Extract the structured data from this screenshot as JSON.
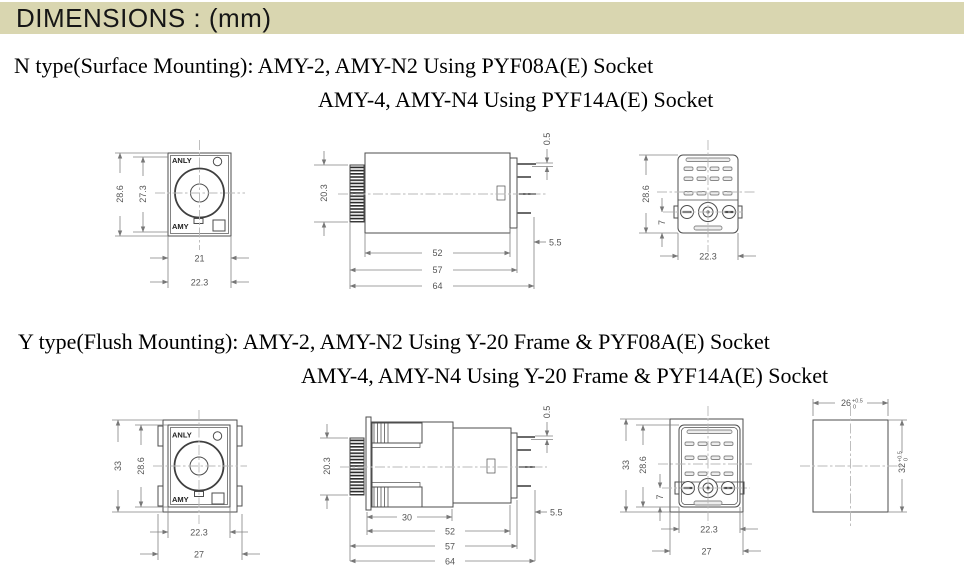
{
  "header": {
    "title": "DIMENSIONS : (mm)"
  },
  "colors": {
    "title_bg": "#d9d6b0",
    "drawing_line": "#4d4d4d",
    "dim_text": "#555555"
  },
  "sections": {
    "n_type": {
      "heading_line1": "N type(Surface Mounting): AMY-2, AMY-N2 Using PYF08A(E) Socket",
      "heading_line2": "AMY-4, AMY-N4 Using PYF14A(E) Socket",
      "front_view": {
        "label_top": "ANLY",
        "label_bottom": "AMY",
        "dim_outer_height": "28.6",
        "dim_inner_height": "27.3",
        "dim_inner_width": "21",
        "dim_outer_width": "22.3"
      },
      "side_view": {
        "dim_knob_height": "20.3",
        "dim_pin_thickness": "0.5",
        "dim_body_length": "52",
        "dim_body_knob_length": "57",
        "dim_total_length": "64",
        "dim_pin_length": "5.5"
      },
      "socket_view": {
        "dim_height": "28.6",
        "dim_screw_offset": "7",
        "dim_width": "22.3"
      }
    },
    "y_type": {
      "heading_line1": "Y type(Flush Mounting): AMY-2, AMY-N2 Using Y-20 Frame & PYF08A(E) Socket",
      "heading_line2": "AMY-4, AMY-N4 Using Y-20 Frame & PYF14A(E) Socket",
      "front_view": {
        "label_top": "ANLY",
        "label_bottom": "AMY",
        "dim_outer_height": "33",
        "dim_inner_height": "28.6",
        "dim_inner_width": "22.3",
        "dim_outer_width": "27"
      },
      "side_view": {
        "dim_knob_height": "20.3",
        "dim_pin_thickness": "0.5",
        "dim_frame_depth": "30",
        "dim_body_length": "52",
        "dim_body_knob_length": "57",
        "dim_total_length": "64",
        "dim_pin_length": "5.5"
      },
      "socket_view": {
        "dim_outer_height": "33",
        "dim_inner_height": "28.6",
        "dim_screw_offset": "7",
        "dim_inner_width": "22.3",
        "dim_outer_width": "27"
      },
      "cutout_view": {
        "dim_width": "26",
        "dim_width_tol_upper": "+0.5",
        "dim_width_tol_lower": "0",
        "dim_height": "32",
        "dim_height_tol_upper": "+0.5",
        "dim_height_tol_lower": "0"
      }
    }
  }
}
